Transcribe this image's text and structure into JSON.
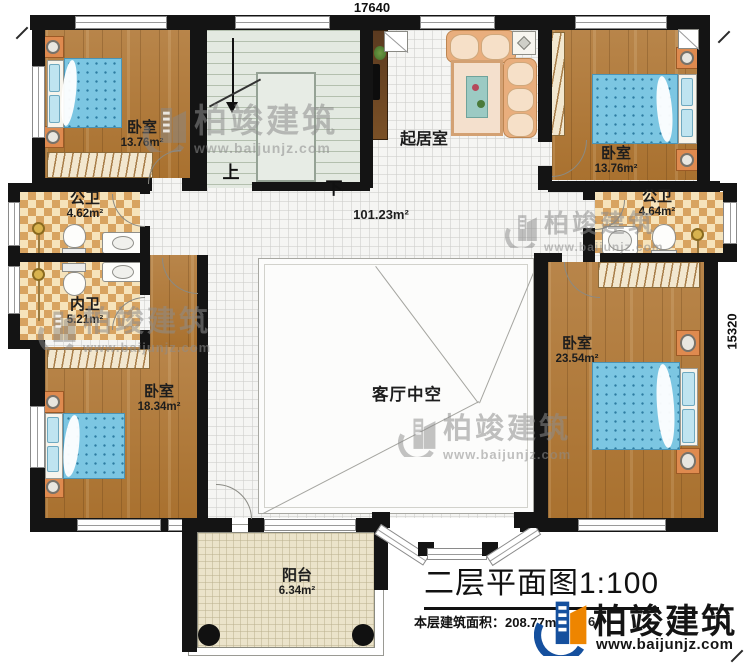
{
  "dimensions": {
    "top": "17640",
    "right": "15320"
  },
  "stairs": {
    "up": "上",
    "down": "下"
  },
  "rooms": {
    "bedroom_tl": {
      "name": "卧室",
      "area": "13.76m²"
    },
    "bedroom_tr": {
      "name": "卧室",
      "area": "13.76m²"
    },
    "bedroom_bl": {
      "name": "卧室",
      "area": "18.34m²"
    },
    "bedroom_br": {
      "name": "卧室",
      "area": "23.54m²"
    },
    "bath_left_public": {
      "name": "公卫",
      "area": "4.62m²"
    },
    "bath_left_private": {
      "name": "内卫",
      "area": "5.21m²"
    },
    "bath_right_public": {
      "name": "公卫",
      "area": "4.64m²"
    },
    "living": {
      "name": "起居室",
      "area": "101.23m²"
    },
    "void": {
      "name": "客厅中空"
    },
    "balcony": {
      "name": "阳台",
      "area": "6.34m²"
    }
  },
  "footer": {
    "title": "二层平面图1:100",
    "floor_area_label": "本层建筑面积：208.77m²",
    "hidden_fragment": "6"
  },
  "brand": {
    "name": "柏竣建筑",
    "url": "www.baijunjz.com"
  },
  "watermark": {
    "name": "柏竣建筑",
    "url": "www.baijunjz.com"
  }
}
